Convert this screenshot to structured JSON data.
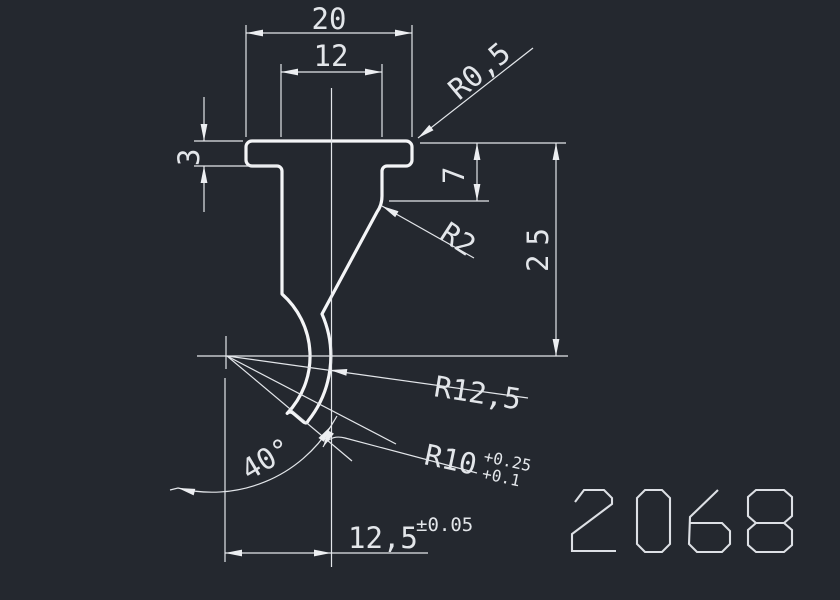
{
  "drawing": {
    "background_color": "#24282f",
    "line_color": "#e3e6ea",
    "part_outline_color": "#f4f5f7",
    "drawing_number": "2068",
    "type": "press-brake punch profile, front view"
  },
  "labels": {
    "top_width": "20",
    "shank_width": "12",
    "flange_thickness": "3",
    "flange_corner_radius": "R0,5",
    "shoulder_depth": "7",
    "body_height": "25",
    "shoulder_fillet_radius": "R2",
    "outer_blade_radius": "R12,5",
    "tip_radius": "R10",
    "tip_radius_tol_upper": "+0.25",
    "tip_radius_tol_lower": "+0.1",
    "tip_angle": "40°",
    "tip_offset": "12,5",
    "tip_offset_tol": "±0.05"
  }
}
